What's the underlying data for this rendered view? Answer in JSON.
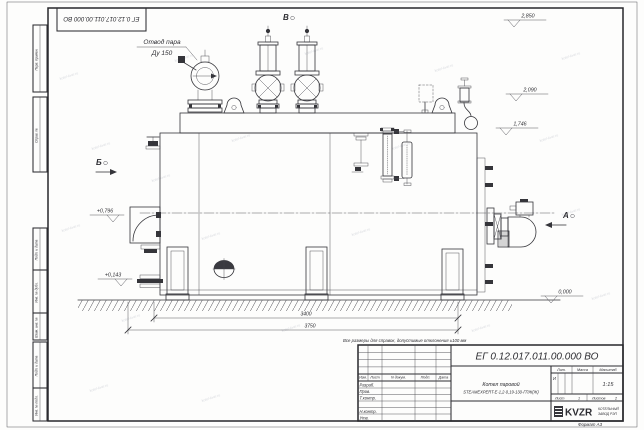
{
  "watermark": {
    "text": "kotel-kvzr.ru"
  },
  "corner_stamp": "ЕГ 0.12.017.011.00.000  ВО",
  "margin": {
    "perv": "Перв. примен.",
    "sprav": "Справ. №",
    "podp1": "Подп. и дата",
    "inv_dubl": "Инв. № дубл.",
    "vzam": "Взам. инв. №",
    "podp2": "Подп. и дата",
    "inv_podl": "Инв. № подл."
  },
  "labels": {
    "steam1": "Отвод пара",
    "steam2": "Ду 150",
    "view_b": "В",
    "view_b_side": "Б",
    "view_a": "А",
    "elev_2850": "2,850",
    "elev_2090": "2,090",
    "elev_1746": "1,746",
    "elev_0000": "0,000",
    "elev_0796": "+0,796",
    "elev_0143": "+0,143",
    "dim_3400": "3400",
    "dim_3750": "3750"
  },
  "note": "Все размеры для справок, допустимые отклонения ±100 мм",
  "tb": {
    "designation": "ЕГ 0.12.017.011.00.000  ВО",
    "product1": "Котел паровой",
    "product2": "STEAMEXPERT-Е-1,2-0,19-130-ГПЖ(Ж)",
    "h_izm": "Изм.",
    "h_list": "Лист",
    "h_doc": "N докум.",
    "h_podp": "Подп.",
    "h_data": "Дата",
    "r_razrab": "Разраб.",
    "r_prov": "Пров.",
    "r_tkontr": "Т.контр.",
    "r_nkontr": "Н.контр.",
    "r_utv": "Утв.",
    "lit_label": "Лит.",
    "lit_value": "И",
    "massa_label": "Масса",
    "scale_label": "Масштаб",
    "scale_value": "1:15",
    "sheet_label": "Лист",
    "sheet_value": "1",
    "sheets_label": "Листов",
    "sheets_value": "2",
    "org_logo": "KVZR",
    "org1": "КОТЕЛЬНЫЙ",
    "org2": "ЗАВОД РЭП",
    "format": "Формат А3"
  }
}
